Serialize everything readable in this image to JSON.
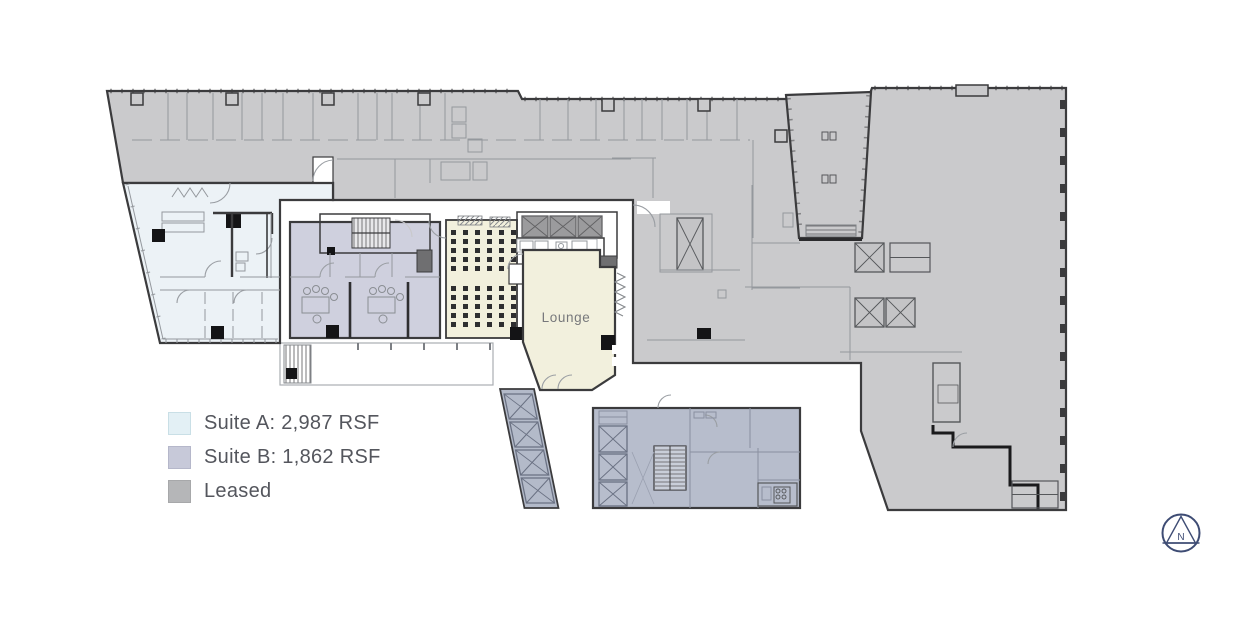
{
  "legend": {
    "items": [
      {
        "id": "suite-a",
        "label": "Suite A: 2,987 RSF",
        "swatch_color": "#E3F0F5",
        "swatch_border": "#C9DFE6"
      },
      {
        "id": "suite-b",
        "label": "Suite B: 1,862 RSF",
        "swatch_color": "#C7C9D9",
        "swatch_border": "#B5B7CA"
      },
      {
        "id": "leased",
        "label": "Leased",
        "swatch_color": "#B5B6B8",
        "swatch_border": "#A7A8AA"
      }
    ]
  },
  "floor_plan": {
    "room_labels": [
      {
        "id": "lounge",
        "text": "Lounge"
      }
    ],
    "north_arrow": {
      "letter": "N",
      "color": "#3E4C74"
    },
    "region_colors": {
      "suite_a": "#ECF2F6",
      "suite_b": "#CFD0DE",
      "leased": "#CACACC",
      "lounge_amenity": "#F2F0DD",
      "building_core": "#B7BDCC",
      "stair_elevator_core": "#6F6F71",
      "wall": "#3B3B3D"
    },
    "seating": {
      "cols": 6,
      "col_start_x": 451,
      "col_step": 12,
      "square_size": 5,
      "row_ys": [
        230,
        239,
        248,
        257,
        266,
        286,
        295,
        304,
        313,
        322
      ]
    }
  }
}
